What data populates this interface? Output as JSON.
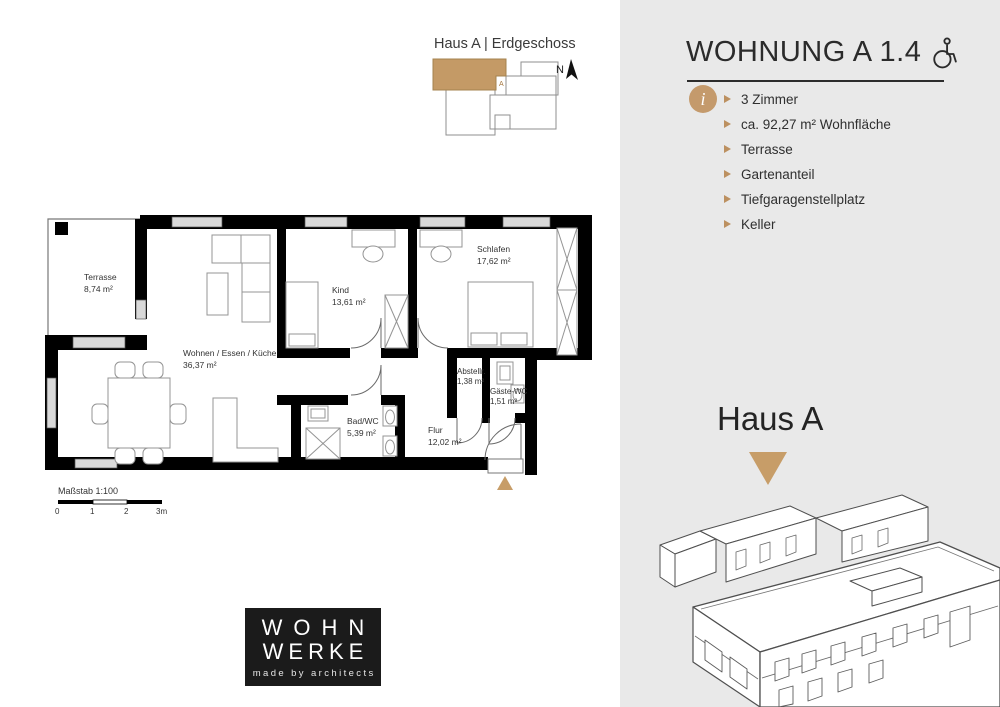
{
  "site_plan": {
    "title": "Haus A | Erdgeschoss",
    "unit_label": "A",
    "north_label": "N"
  },
  "panel": {
    "title": "WOHNUNG A 1.4",
    "info_icon": "i",
    "features": [
      "3 Zimmer",
      "ca. 92,27 m² Wohnfläche",
      "Terrasse",
      "Gartenanteil",
      "Tiefgaragenstellplatz",
      "Keller"
    ],
    "house_label": "Haus A"
  },
  "floor_plan": {
    "rooms": [
      {
        "name": "Terrasse",
        "area": "8,74 m²"
      },
      {
        "name": "Wohnen / Essen / Küche",
        "area": "36,37 m²"
      },
      {
        "name": "Kind",
        "area": "13,61 m²"
      },
      {
        "name": "Schlafen",
        "area": "17,62 m²"
      },
      {
        "name": "Abstellr.",
        "area": "1,38 m²"
      },
      {
        "name": "Gäste-WC",
        "area": "1,51 m²"
      },
      {
        "name": "Bad/WC",
        "area": "5,39 m²"
      },
      {
        "name": "Flur",
        "area": "12,02 m²"
      }
    ],
    "scale": {
      "label": "Maßstab 1:100",
      "ticks": [
        "0",
        "1",
        "2",
        "3m"
      ]
    }
  },
  "logo": {
    "line1": "WOHN",
    "line2": "WERKE",
    "tagline": "made by architects"
  },
  "colors": {
    "accent": "#c49a66",
    "panel_bg": "#e9e9e9",
    "wall": "#000000",
    "logo_bg": "#1b1b1b"
  }
}
